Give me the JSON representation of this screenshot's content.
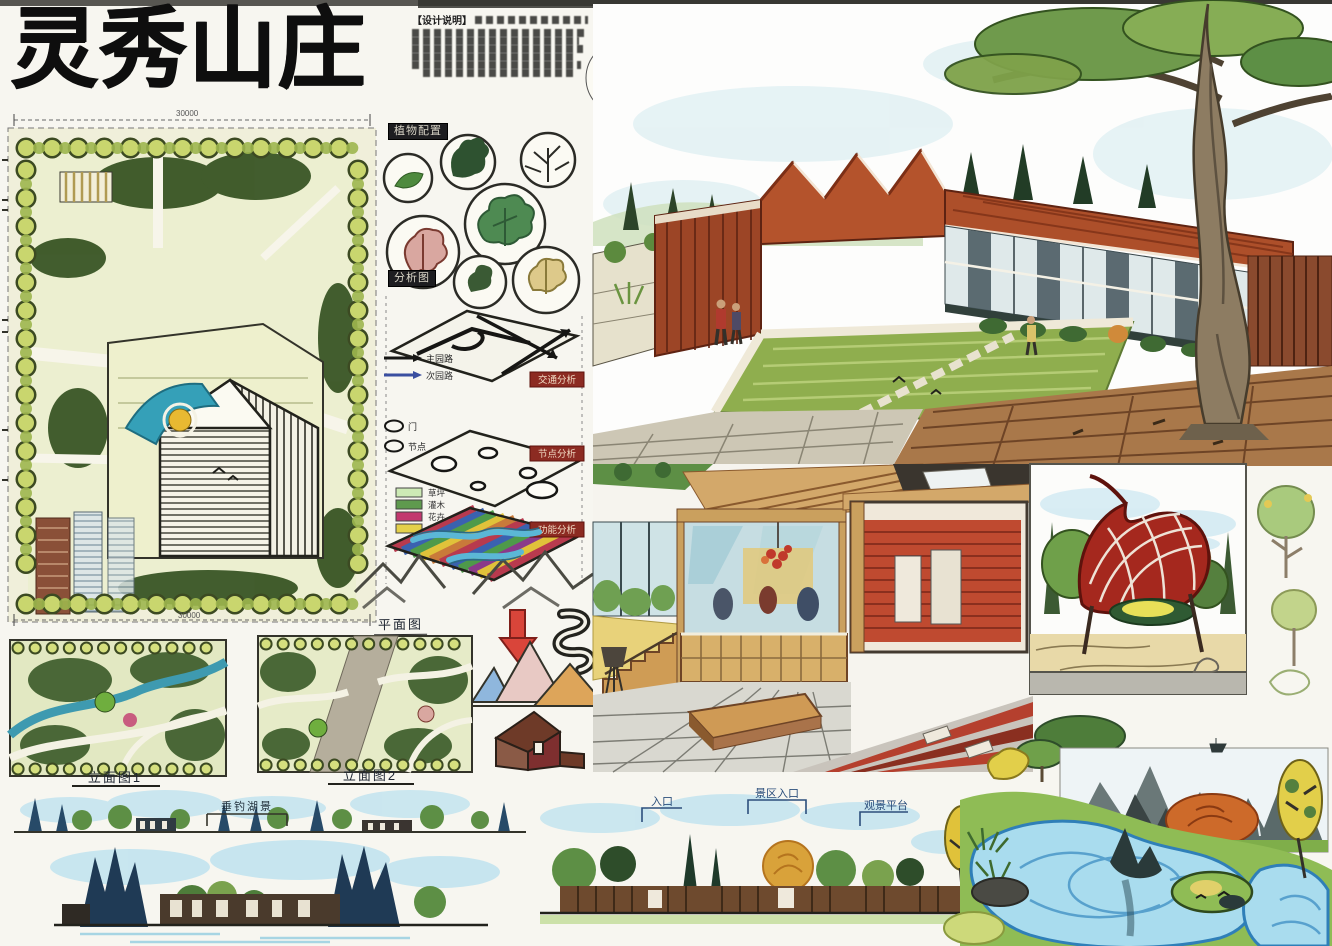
{
  "board": {
    "title": "灵秀山庄",
    "notes_label": "【设计说明】",
    "dim_top": "30000",
    "dim_bottom": "30000"
  },
  "labels": {
    "plant_legend": "植物配置",
    "analysis_legend": "分析图",
    "traffic_analysis": "交通分析",
    "node_analysis": "节点分析",
    "function_analysis": "功能分析",
    "route_main": "主园路",
    "route_secondary": "次园路",
    "gate": "门",
    "node": "节点",
    "plan": "平面图",
    "elevation_1": "立面图1",
    "elevation_2": "立面图2",
    "lake_view": "垂钓湖景",
    "entrance": "入口",
    "scenic_entrance": "景区入口",
    "viewing_platform": "观景平台"
  },
  "zone_legend": [
    {
      "label": "草坪",
      "color": "#cdeab5"
    },
    {
      "label": "灌木",
      "color": "#5f9a4e"
    },
    {
      "label": "花卉",
      "color": "#c2386e"
    },
    {
      "label": "花架",
      "color": "#e4d04a"
    }
  ],
  "palette": {
    "ink": "#2b2b26",
    "roof_red": "#b4532c",
    "water_teal": "#35a0b8",
    "lawn_green": "#8fae4e",
    "pond_blue": "#a9dcee",
    "pavilion_red": "#a5281e",
    "tree_yellow_green": "#cdd97a",
    "callout_blue": "#2c4f7c",
    "chip_red": "#8c2b22"
  }
}
